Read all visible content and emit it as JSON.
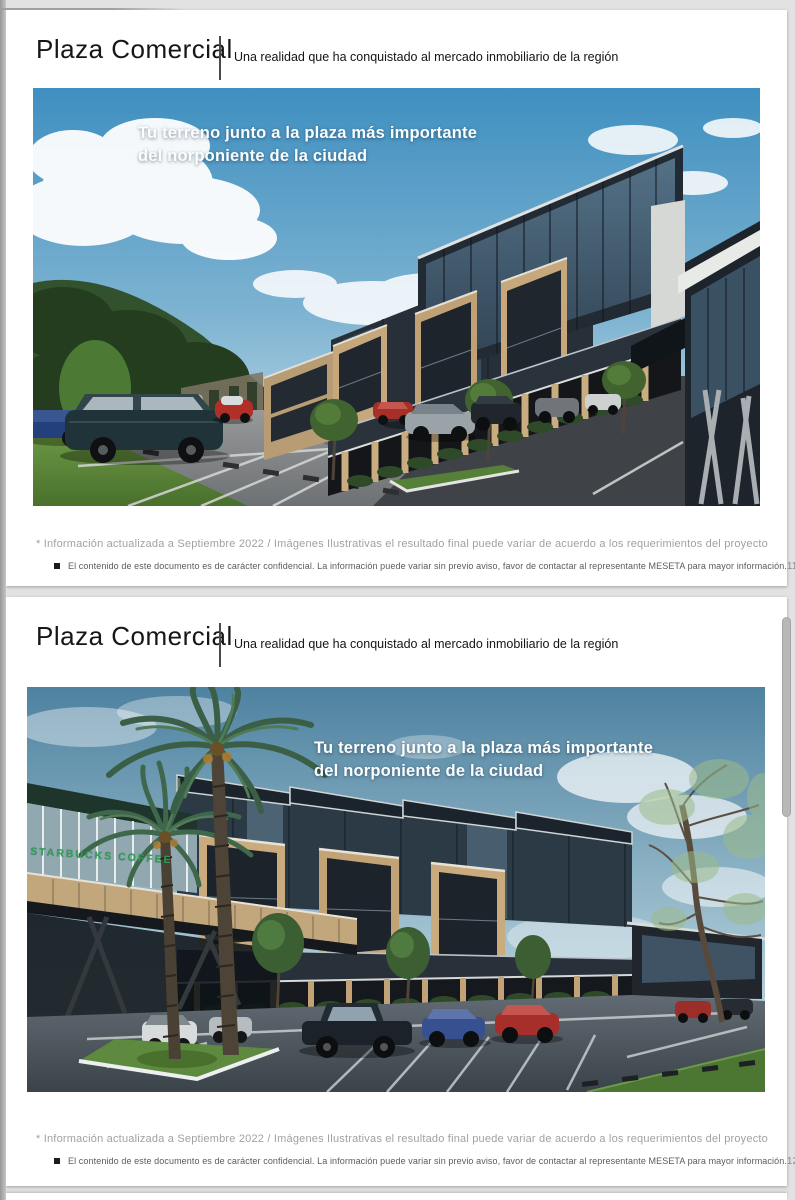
{
  "slides": [
    {
      "header": {
        "title": "Plaza Comercial",
        "subtitle": "Una realidad que ha conquistado al mercado inmobiliario de la región"
      },
      "render": {
        "caption_line1": "Tu terreno junto a la plaza más importante",
        "caption_line2": "del norponiente de la ciudad"
      },
      "footer": {
        "note": "* Información actualizada a Septiembre 2022 / Imágenes Ilustrativas el resultado final puede variar de acuerdo a los requerimientos del proyecto",
        "confidential": "El contenido de este documento es de carácter confidencial. La información puede variar sin previo aviso, favor de contactar al representante MESETA para mayor información.",
        "page_number": "11"
      }
    },
    {
      "header": {
        "title": "Plaza Comercial",
        "subtitle": "Una realidad que ha conquistado al mercado inmobiliario de la región"
      },
      "render": {
        "caption_line1": "Tu terreno junto a la plaza más importante",
        "caption_line2": "del norponiente de la ciudad",
        "signage": "STARBUCKS COFFEE"
      },
      "footer": {
        "note": "* Información actualizada a Septiembre 2022 / Imágenes Ilustrativas el resultado final puede variar de acuerdo a los requerimientos del proyecto",
        "confidential": "El contenido de este documento es de carácter confidencial. La información puede variar sin previo aviso, favor de contactar al representante MESETA para mayor información.",
        "page_number": "12"
      }
    }
  ],
  "colors": {
    "sky_top": "#3f8fc0",
    "sky_top_slide2": "#4e82a0",
    "building_dark": "#1d242b",
    "brick_tan": "#c6a87c",
    "asphalt": "#7e8183",
    "asphalt_dark": "#3f4347",
    "grass_green": "#5d8a3f",
    "signage_green": "#2f9e57",
    "caption_white": "#fbfdfe",
    "disclaimer_grey": "#a3a19e"
  }
}
